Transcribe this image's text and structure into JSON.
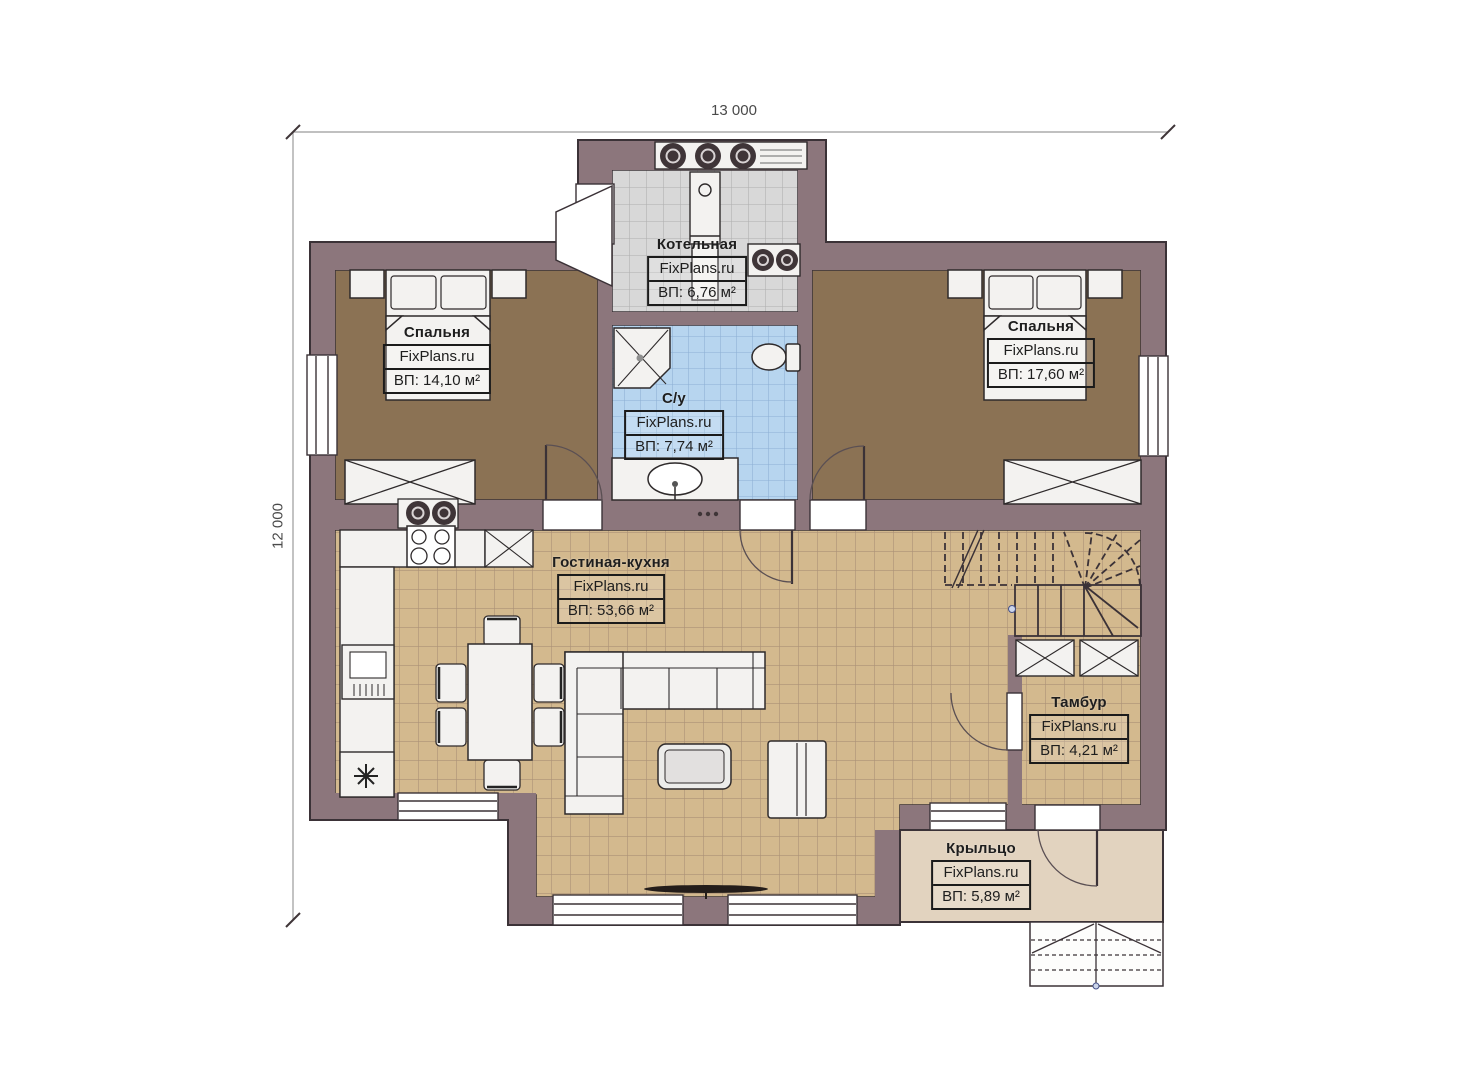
{
  "dimensions": {
    "width_label": "13 000",
    "height_label": "12 000"
  },
  "rooms": {
    "boiler": {
      "name": "Котельная",
      "brand": "FixPlans.ru",
      "area": "ВП: 6,76 м²"
    },
    "bedroom_left": {
      "name": "Спальня",
      "brand": "FixPlans.ru",
      "area": "ВП: 14,10 м²"
    },
    "bedroom_right": {
      "name": "Спальня",
      "brand": "FixPlans.ru",
      "area": "ВП: 17,60 м²"
    },
    "bathroom": {
      "name": "С/у",
      "brand": "FixPlans.ru",
      "area": "ВП: 7,74 м²"
    },
    "living_kitchen": {
      "name": "Гостиная-кухня",
      "brand": "FixPlans.ru",
      "area": "ВП: 53,66 м²"
    },
    "vestibule": {
      "name": "Тамбур",
      "brand": "FixPlans.ru",
      "area": "ВП: 4,21 м²"
    },
    "porch": {
      "name": "Крыльцо",
      "brand": "FixPlans.ru",
      "area": "ВП: 5,89 м²"
    }
  },
  "colors": {
    "wall": "#8c767c",
    "outline": "#3b3237",
    "bedroom_floor": "#8b7254",
    "living_floor_tile": "#d3b98e",
    "bathroom_floor_tile": "#b7d5ef",
    "boiler_floor_tile": "#d8d8d8",
    "porch_floor": "#e2d3bf",
    "background": "#ffffff"
  }
}
